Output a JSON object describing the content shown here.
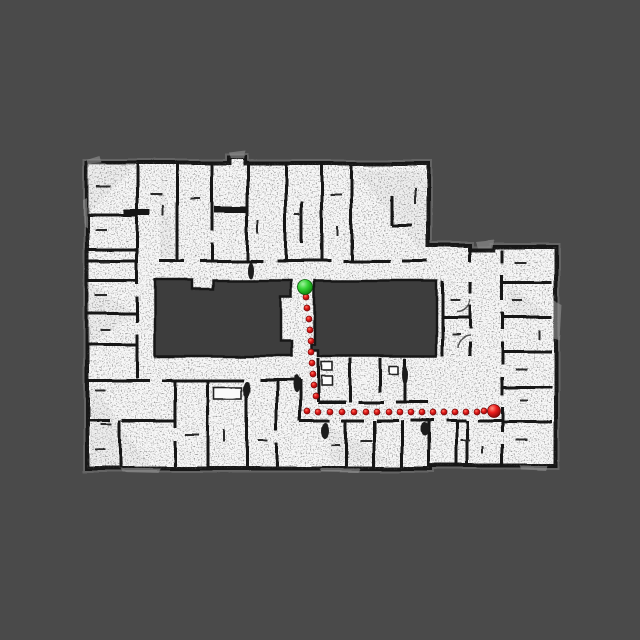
{
  "scene": {
    "description": "occupancy-grid floor plan with planned robot path",
    "colors": {
      "background": "#4a4a4a",
      "floor": "#f7f7f7",
      "wall": "#161616",
      "unknown_region": "#3e3e3e",
      "path_red": "#e51a1a",
      "start_green": "#2fcf2f"
    },
    "path": {
      "dot_radius": 3,
      "dot_gradient": [
        "#ff7a66",
        "#e51a1a",
        "#8f0c0c"
      ],
      "dots": [
        [
          306,
          297
        ],
        [
          307,
          308
        ],
        [
          309,
          319
        ],
        [
          310,
          330
        ],
        [
          311,
          341
        ],
        [
          311,
          352
        ],
        [
          312,
          363
        ],
        [
          313,
          374
        ],
        [
          314,
          385
        ],
        [
          316,
          396
        ],
        [
          307,
          411
        ],
        [
          318,
          412
        ],
        [
          330,
          412
        ],
        [
          342,
          412
        ],
        [
          354,
          412
        ],
        [
          366,
          412
        ],
        [
          377,
          412
        ],
        [
          389,
          412
        ],
        [
          400,
          412
        ],
        [
          411,
          412
        ],
        [
          422,
          412
        ],
        [
          433,
          412
        ],
        [
          444,
          412
        ],
        [
          455,
          412
        ],
        [
          466,
          412
        ],
        [
          477,
          412
        ],
        [
          484,
          411
        ]
      ]
    },
    "markers": {
      "start": {
        "label": "start",
        "x": 305,
        "y": 287,
        "radius": 7.5,
        "gradient": [
          "#9ff29f",
          "#35d435",
          "#0d7e0d"
        ]
      },
      "goal": {
        "label": "goal",
        "x": 494,
        "y": 411,
        "radius": 6.5,
        "gradient": [
          "#ff9180",
          "#ee1c1c",
          "#7e0909"
        ]
      }
    }
  }
}
